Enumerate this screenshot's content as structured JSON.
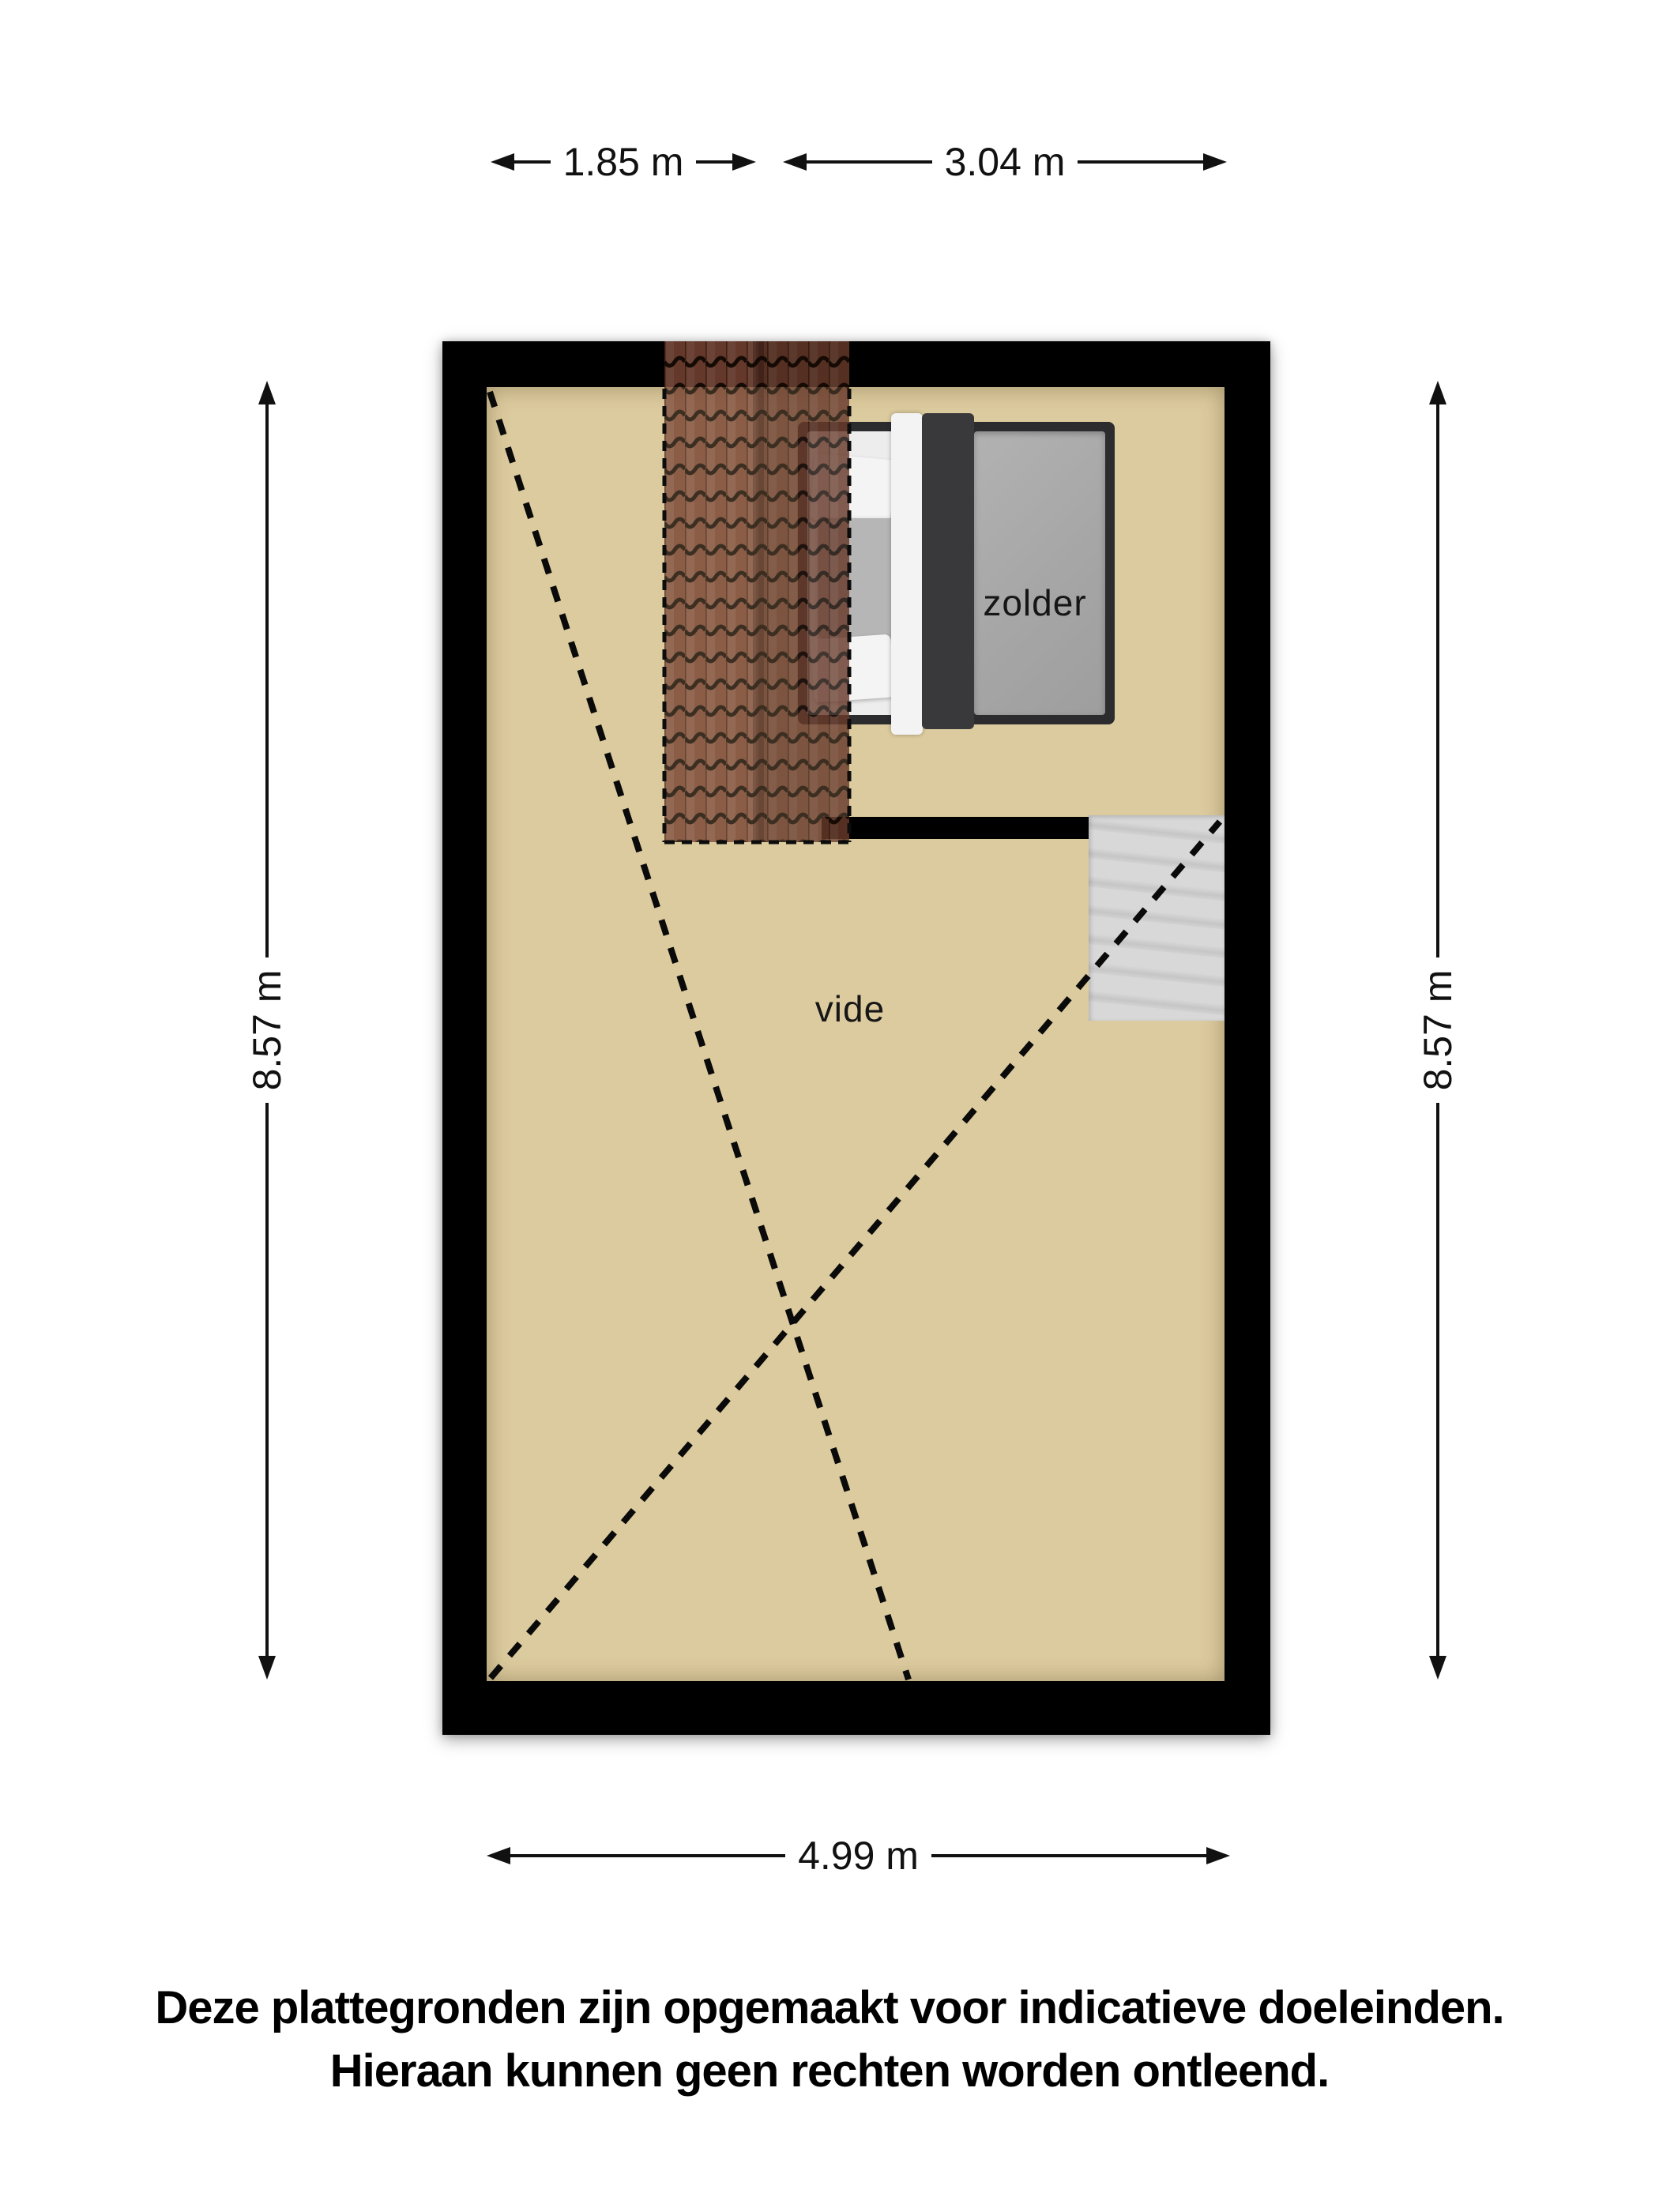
{
  "rooms": {
    "zolder": "zolder",
    "vide": "vide"
  },
  "dimensions": {
    "top_left": "1.85 m",
    "top_right": "3.04 m",
    "left": "8.57 m",
    "right": "8.57 m",
    "bottom": "4.99 m"
  },
  "disclaimer": {
    "line1": "Deze plattegronden zijn opgemaakt voor indicatieve doeleinden.",
    "line2": "Hieraan kunnen geen rechten worden ontleend."
  },
  "colors": {
    "floor": "#dccb9e",
    "wall": "#000000",
    "roof_tile": "#7a4534",
    "roof_tile_line": "#1a0e07",
    "stairs": "#d2d2d2",
    "bed_frame": "#2c2c2e",
    "bed_duvet": "#a8a8a8",
    "bed_sheet": "#ededed",
    "dimension_text": "#111111"
  }
}
